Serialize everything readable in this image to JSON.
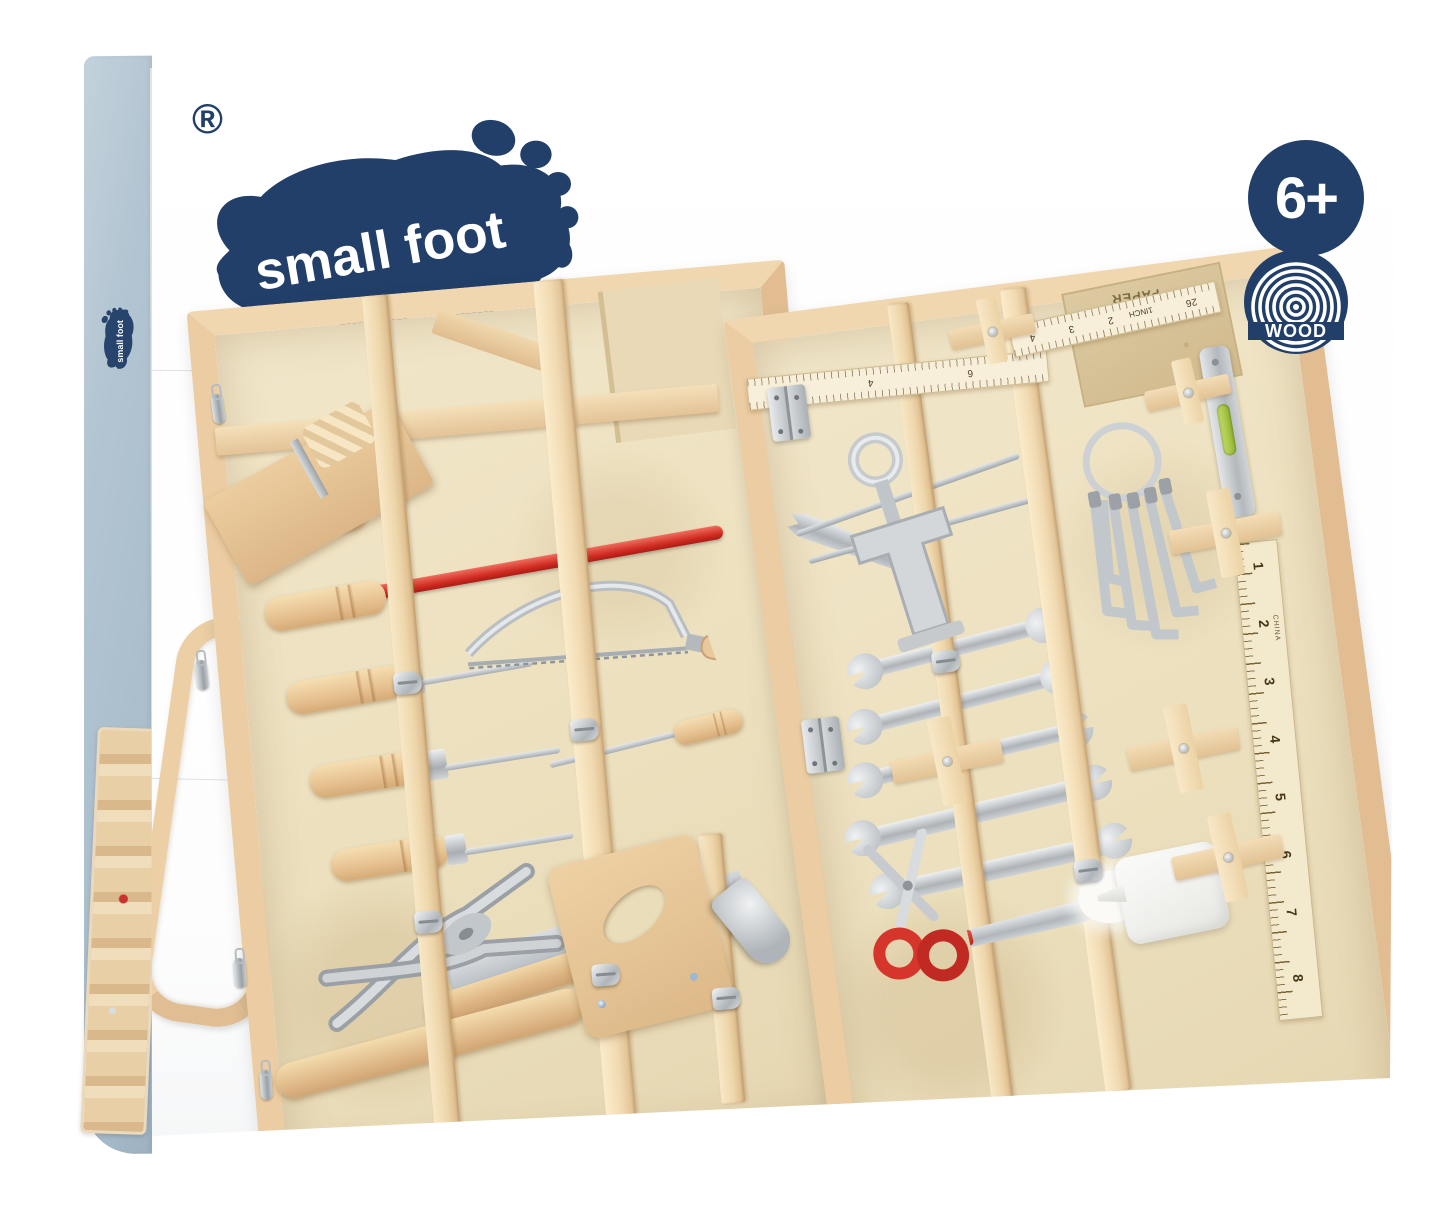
{
  "brand": {
    "name": "small foot",
    "registered": "®"
  },
  "badges": {
    "age": "6+",
    "material": {
      "label": "WOOD"
    }
  },
  "colors": {
    "brand_navy": "#223f69",
    "box_side_blue": "#b3c5d2",
    "wood_frame": "#e4c096",
    "wood_light": "#f3e0c0",
    "panel_wood": "#ece1c3",
    "accent_red": "#d53a31",
    "metal_silver": "#c9cdd0",
    "level_green": "#9fc43c",
    "glue_white": "#f8f8f6",
    "sandpaper_tan": "#d5c094"
  },
  "toolbox": {
    "left_wing_tools": [
      "wood-plane",
      "sanding-block",
      "red-rod",
      "coping-saw",
      "screwdriver",
      "chisel-handles-x5",
      "saw-handle-holder",
      "saw-blade",
      "slip-joint-pliers",
      "hammer",
      "wooden-rod",
      "carry-handle",
      "metal-clasps"
    ],
    "right_wing_tools": [
      "folding-ruler",
      "sandpaper-sheet",
      "screw-clamp",
      "hex-key-set",
      "spirit-level",
      "wooden-ruler",
      "pry-bar",
      "awls",
      "open-end-wrenches-x5",
      "scissors",
      "utility-knife",
      "cotton-wrap",
      "glue-bottle",
      "holder-crosses"
    ],
    "folding_ruler": {
      "segment_a": [
        "10",
        "4",
        "6"
      ],
      "segment_b": [
        "4",
        "3",
        "2",
        "1INCH",
        "26"
      ]
    },
    "vertical_ruler": {
      "numbers": [
        "1",
        "2",
        "3",
        "4",
        "5",
        "6",
        "7",
        "8"
      ],
      "origin_label": "CHINA"
    },
    "sandpaper_label": "PAPER"
  }
}
